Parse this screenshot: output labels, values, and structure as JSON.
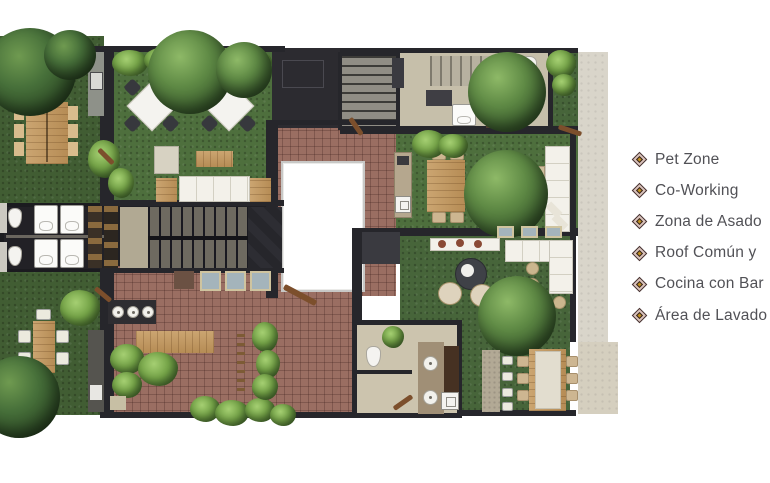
{
  "legend": {
    "items": [
      {
        "icon": "diamond-bullet-icon",
        "label": "Pet Zone"
      },
      {
        "icon": "diamond-bullet-icon",
        "label": "Co-Working"
      },
      {
        "icon": "diamond-bullet-icon",
        "label": "Zona de Asado"
      },
      {
        "icon": "diamond-bullet-icon",
        "label": "Roof Común y"
      },
      {
        "icon": "diamond-bullet-icon",
        "label": "Cocina con Bar"
      },
      {
        "icon": "diamond-bullet-icon",
        "label": "Área de Lavado"
      }
    ],
    "text_color": "#515156",
    "bullet_colors": {
      "outline": "#43302f",
      "fill": "#d9c2bc",
      "center": "#c08f1f"
    }
  },
  "plan_colors": {
    "lawn": "#4e6f3d",
    "lawn_dark": "#415d33",
    "terracotta_tile": "#9a6e62",
    "wall": "#26262b",
    "room_beige": "#c6bfaa",
    "sidewalk": "#d9d5ca",
    "wood": "#c29a66",
    "white_furniture": "#f3f1ea",
    "skylight_glass": "#a4b4bb",
    "tree_foliage": "#4a7334"
  }
}
